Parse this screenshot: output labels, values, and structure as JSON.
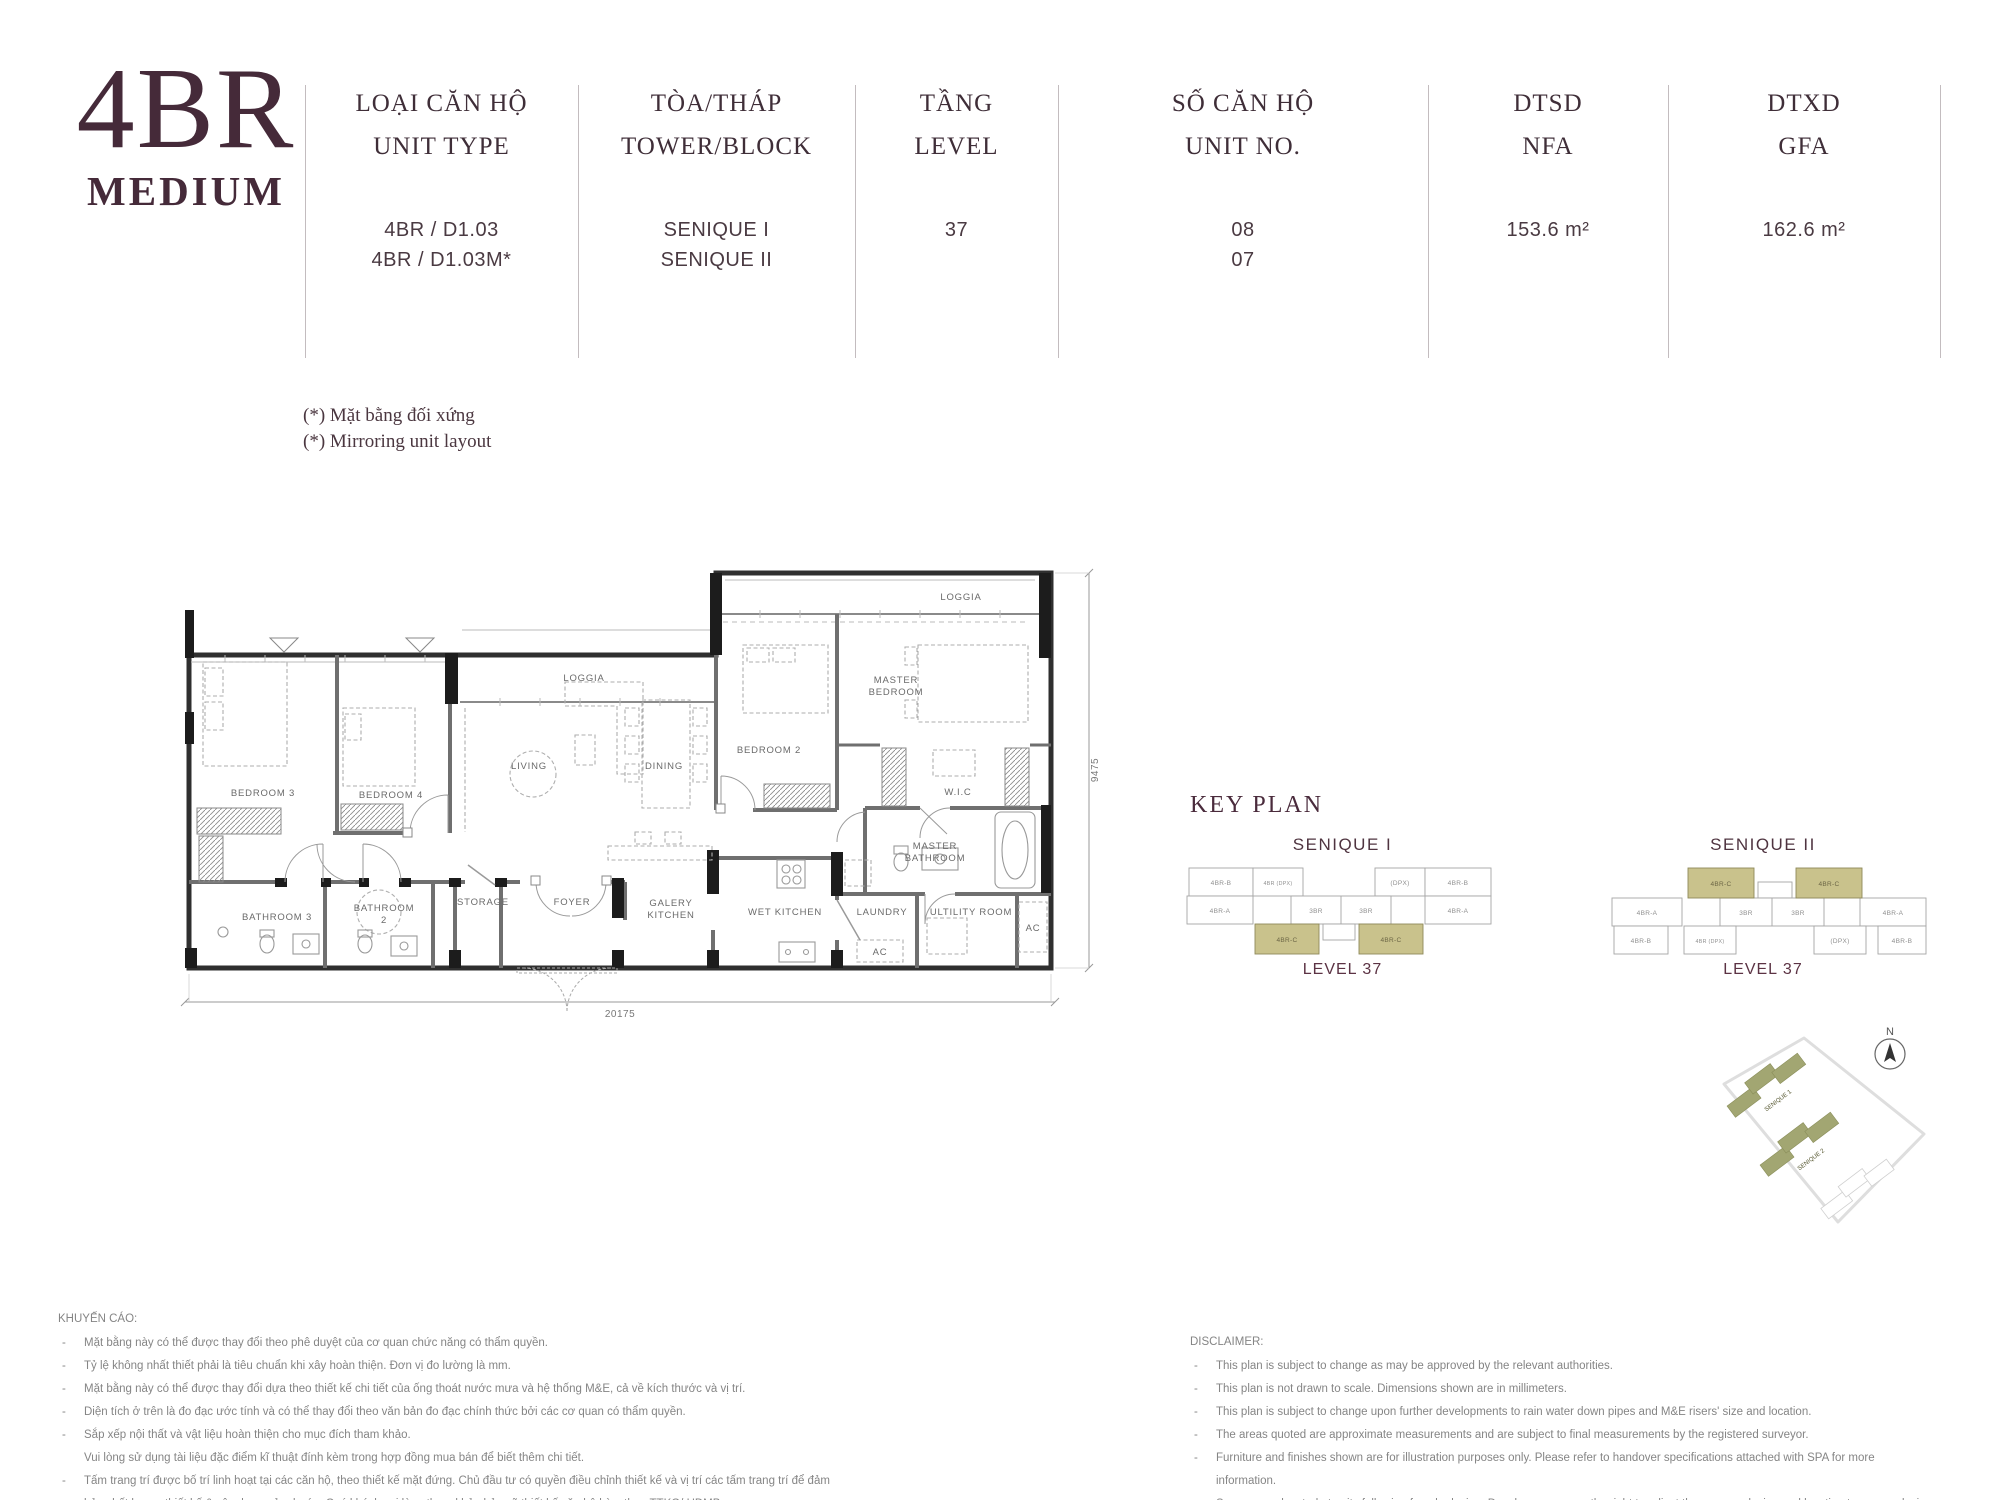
{
  "colors": {
    "accent_maroon": "#452a39",
    "keyplan_highlight": "#c9c28c",
    "keyplan_highlight_border": "#8f8a5a",
    "wall_dark": "#2f2f2f",
    "wall_mid": "#6f6f6f"
  },
  "header": {
    "title": "4BR",
    "subtitle": "MEDIUM",
    "columns": [
      {
        "label_vi": "LOẠI CĂN HỘ",
        "label_en": "UNIT TYPE",
        "values": [
          "4BR / D1.03",
          "4BR / D1.03M*"
        ]
      },
      {
        "label_vi": "TÒA/THÁP",
        "label_en": "TOWER/BLOCK",
        "values": [
          "SENIQUE I",
          "SENIQUE II"
        ]
      },
      {
        "label_vi": "TẦNG",
        "label_en": "LEVEL",
        "values": [
          "37"
        ]
      },
      {
        "label_vi": "SỐ CĂN HỘ",
        "label_en": "UNIT NO.",
        "values": [
          "08",
          "07"
        ]
      },
      {
        "label_vi": "DTSD",
        "label_en": "NFA",
        "values": [
          "153.6 m²"
        ]
      },
      {
        "label_vi": "DTXD",
        "label_en": "GFA",
        "values": [
          "162.6 m²"
        ]
      }
    ]
  },
  "note": {
    "line1": "(*) Mặt bằng đối xứng",
    "line2": "(*) Mirroring unit layout"
  },
  "floorplan": {
    "rooms": {
      "loggia_right": "LOGGIA",
      "loggia_mid": "LOGGIA",
      "master_bedroom": [
        "MASTER",
        "BEDROOM"
      ],
      "bedroom2": "BEDROOM 2",
      "bedroom3": "BEDROOM 3",
      "bedroom4": "BEDROOM 4",
      "wic": "W.I.C",
      "master_bathroom": [
        "MASTER",
        "BATHROOM"
      ],
      "living": "LIVING",
      "dining": "DINING",
      "bathroom3": "BATHROOM 3",
      "bathroom2": [
        "BATHROOM",
        "2"
      ],
      "storage": "STORAGE",
      "foyer": "FOYER",
      "galery_kitchen": [
        "GALERY",
        "KITCHEN"
      ],
      "wet_kitchen": "WET KITCHEN",
      "laundry": "LAUNDRY",
      "utility_room": "ULTILITY ROOM",
      "ac_1": "AC",
      "ac_2": "AC"
    },
    "dimensions": {
      "width": "20175",
      "height": "9475"
    }
  },
  "keyplan": {
    "heading": "KEY PLAN",
    "senique1": {
      "title": "SENIQUE I",
      "level": "LEVEL 37",
      "blocks": [
        "4BR-B",
        "4BR (DPX)",
        "(DPX)",
        "4BR-B",
        "4BR-A",
        "3BR",
        "3BR",
        "4BR-A",
        "4BR-C",
        "4BR-C"
      ]
    },
    "senique2": {
      "title": "SENIQUE II",
      "level": "LEVEL 37",
      "blocks": [
        "4BR-C",
        "4BR-C",
        "4BR-A",
        "3BR",
        "3BR",
        "4BR-A",
        "4BR-B",
        "4BR (DPX)",
        "(DPX)",
        "4BR-B"
      ]
    }
  },
  "siteplan": {
    "north_label": "N",
    "building1": "SENIQUE 1",
    "building2": "SENIQUE 2"
  },
  "advisory": {
    "heading": "KHUYẾN CÁO:",
    "items": [
      {
        "marker": "-",
        "text": "Mặt bằng này có thể được thay đổi theo phê duyệt của cơ quan chức năng có thẩm quyền."
      },
      {
        "marker": "-",
        "text": "Tỷ lệ không nhất thiết phải là tiêu chuẩn khi xây hoàn thiện. Đơn vị đo lường là mm."
      },
      {
        "marker": "-",
        "text": "Mặt bằng này có thể được thay đổi dựa theo thiết kế chi tiết của ống thoát nước mưa và hệ thống M&E, cả về kích thước và vị trí."
      },
      {
        "marker": "-",
        "text": "Diện tích ở trên là đo đạc ước tính và có thể thay đổi theo văn bản đo đạc chính thức bởi các cơ quan có thẩm quyền."
      },
      {
        "marker": "-",
        "text": "Sắp xếp nội thất và vật liệu hoàn thiện cho mục đích tham khảo."
      },
      {
        "marker": "",
        "text": "Vui lòng sử dụng tài liệu đặc điểm kĩ thuật đính kèm trong hợp đồng mua bán để biết thêm chi tiết."
      },
      {
        "marker": "-",
        "text": "Tấm trang trí được bố trí linh hoạt tại các căn hộ, theo thiết kế mặt đứng. Chủ đầu tư có quyền điều chỉnh thiết kế và vị trí các tấm trang trí để đảm bảo chất lượng thiết kế & xây dựng của dự án. Quý khách vui lòng tham khảo bản vẽ thiết kế căn hộ kèm theo TTKQ/ HĐMB."
      }
    ]
  },
  "disclaimer": {
    "heading": "DISCLAIMER:",
    "items": [
      {
        "marker": "-",
        "text": "This plan is subject to change as may be approved by the relevant authorities."
      },
      {
        "marker": "-",
        "text": "This plan is not drawn to scale. Dimensions shown are in millimeters."
      },
      {
        "marker": "-",
        "text": "This plan is subject to change upon further developments to rain water down pipes and M&E risers' size and location."
      },
      {
        "marker": "-",
        "text": "The areas quoted are approximate measurements and are subject to final measurements by the registered surveyor."
      },
      {
        "marker": "-",
        "text": "Furniture and finishes shown are for illustration purposes only. Please refer to handover specifications attached with SPA for more information."
      },
      {
        "marker": "-",
        "text": "Screens are located at units following facade design. Developer reserves the right to adjust the screens design and location to ensure design and construction quality. Please refer to unit contract plan attached with EA/ SPA."
      }
    ]
  }
}
